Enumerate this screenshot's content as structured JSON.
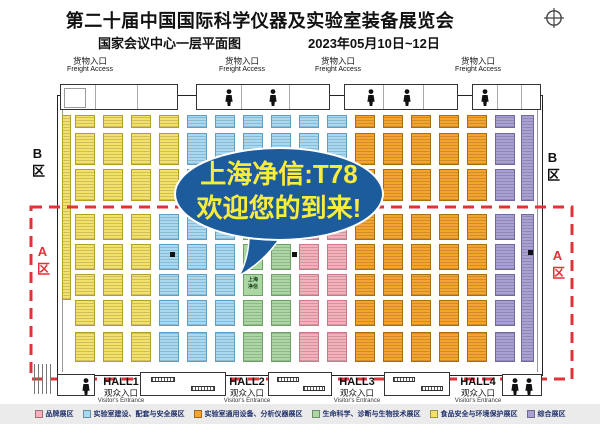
{
  "header": {
    "title": "第二十届中国国际科学仪器及实验室装备展览会",
    "venue": "国家会议中心一层平面图",
    "dates": "2023年05月10日~12日"
  },
  "colors": {
    "accent_red": "#e03237",
    "bubble": "#1d5c9c",
    "bubble_text": "#f8ec3c"
  },
  "bubble": {
    "line1": "上海净信:T78",
    "line2": "欢迎您的到来!"
  },
  "zones": {
    "a": "A区",
    "b": "B区"
  },
  "freight": {
    "cn": "货物入口",
    "en": "Freight Access",
    "centers": [
      90,
      242,
      338,
      478
    ]
  },
  "visitor": {
    "cn": "观众入口",
    "en": "Visitor's Entrance"
  },
  "halls": [
    {
      "name": "HALL1",
      "cx": 121
    },
    {
      "name": "HALL2",
      "cx": 247
    },
    {
      "name": "HALL3",
      "cx": 357
    },
    {
      "name": "HALL4",
      "cx": 478
    }
  ],
  "categories": {
    "brand": {
      "label": "品牌展区",
      "bg": "#f5b0bc",
      "bd": "#c87a88"
    },
    "lab": {
      "label": "实验室建设、配套与安全展区",
      "bg": "#a8d9f2",
      "bd": "#5d9fc7"
    },
    "instrument": {
      "label": "实验室通用设备、分析仪器展区",
      "bg": "#f5a430",
      "bd": "#aa6d10"
    },
    "life": {
      "label": "生命科学、诊断与生物技术展区",
      "bg": "#acd7a5",
      "bd": "#6da265"
    },
    "food": {
      "label": "食品安全与环境保护展区",
      "bg": "#f2e269",
      "bd": "#b3a02b"
    },
    "comprehensive": {
      "label": "综合展区",
      "bg": "#a9a1d2",
      "bd": "#7168a3"
    }
  },
  "legend_order": [
    "brand",
    "lab",
    "instrument",
    "life",
    "food",
    "comprehensive"
  ],
  "floor": {
    "booth_width": 20,
    "columns": [
      75,
      103,
      131,
      159,
      187,
      215,
      243,
      271,
      299,
      327,
      355,
      383,
      411,
      439,
      467,
      495
    ],
    "rows": [
      {
        "y": 115,
        "h": 13,
        "band": "B"
      },
      {
        "y": 133,
        "h": 32,
        "band": "B"
      },
      {
        "y": 169,
        "h": 32,
        "band": "B"
      },
      {
        "y": 214,
        "h": 26,
        "band": "A"
      },
      {
        "y": 244,
        "h": 26,
        "band": "A"
      },
      {
        "y": 274,
        "h": 22,
        "band": "A"
      },
      {
        "y": 300,
        "h": 26,
        "band": "A"
      },
      {
        "y": 332,
        "h": 30,
        "band": "A"
      }
    ],
    "zones": {
      "B": [
        {
          "max": 185,
          "cat": "food"
        },
        {
          "max": 336,
          "cat": "lab"
        },
        {
          "max": 475,
          "cat": "instrument"
        },
        {
          "max": 999,
          "cat": "comprehensive"
        }
      ],
      "A": [
        {
          "max": 145,
          "cat": "food"
        },
        {
          "max": 231,
          "cat": "lab"
        },
        {
          "max": 293,
          "cat": "life"
        },
        {
          "max": 350,
          "cat": "brand"
        },
        {
          "max": 475,
          "cat": "instrument"
        },
        {
          "max": 999,
          "cat": "comprehensive"
        }
      ]
    },
    "strips": [
      {
        "x": 62,
        "y": 115,
        "w": 9,
        "h": 185,
        "cat": "food"
      },
      {
        "x": 521,
        "y": 115,
        "w": 13,
        "h": 86,
        "cat": "comprehensive"
      },
      {
        "x": 521,
        "y": 214,
        "w": 13,
        "h": 148,
        "cat": "comprehensive"
      }
    ],
    "named": [
      {
        "x": 243,
        "y": 244,
        "w": 20,
        "h": 26,
        "cat": "life",
        "label": "上海和信"
      },
      {
        "x": 243,
        "y": 274,
        "w": 20,
        "h": 22,
        "cat": "life",
        "label": "上海净信"
      }
    ],
    "pillars": [
      [
        170,
        252
      ],
      [
        292,
        252
      ],
      [
        528,
        250
      ]
    ]
  }
}
